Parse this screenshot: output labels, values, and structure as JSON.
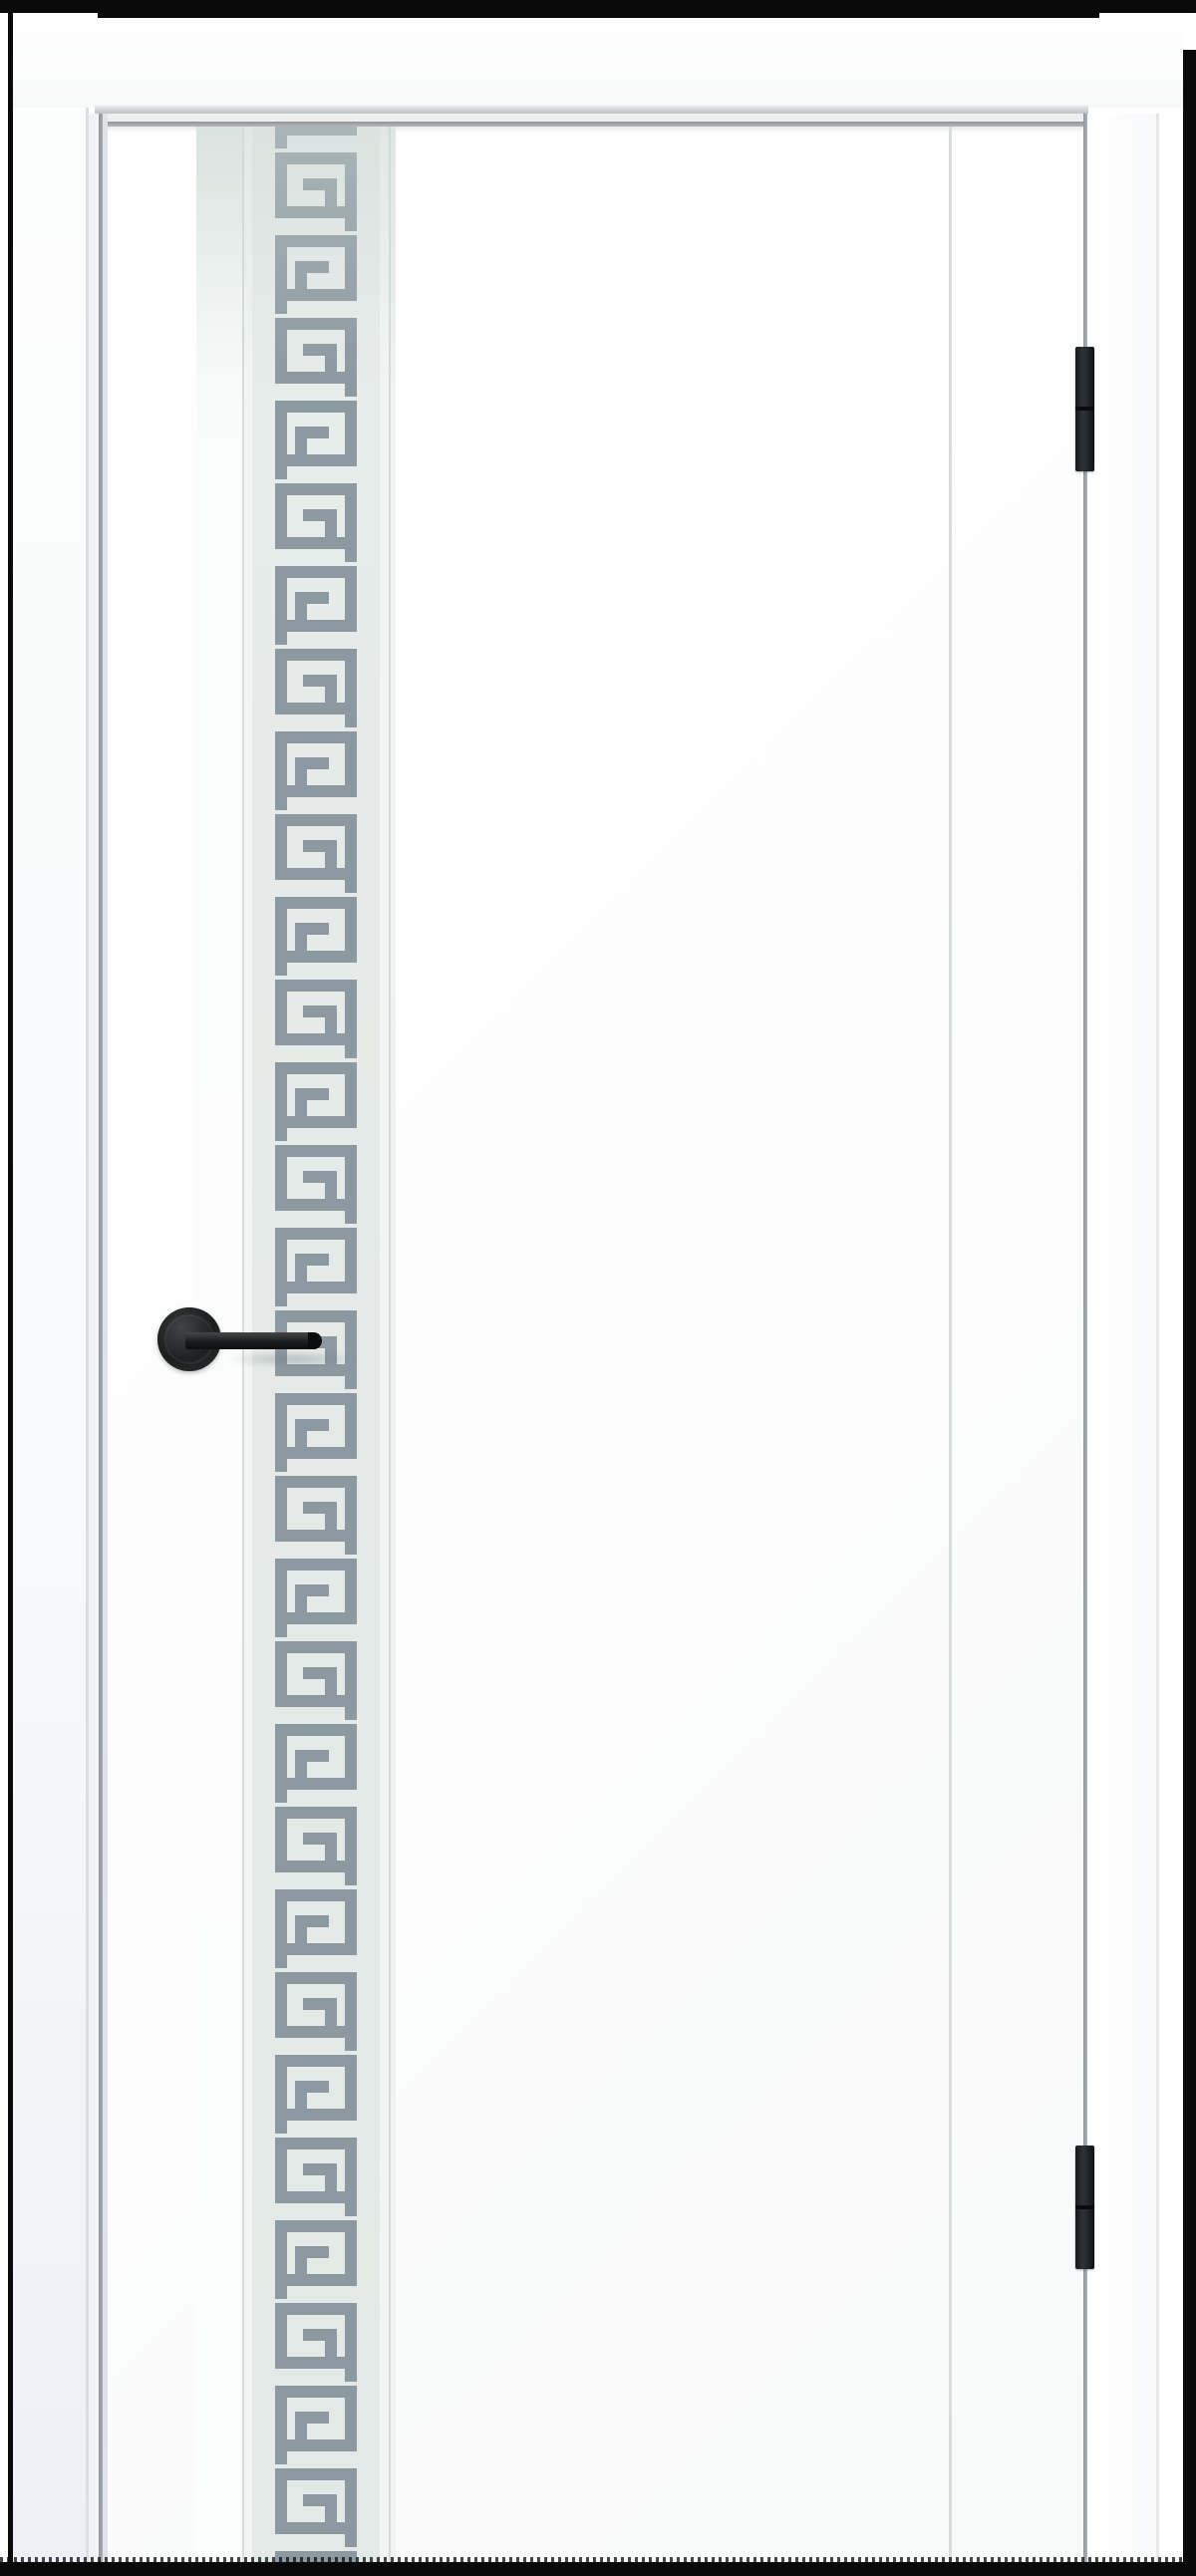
{
  "image": {
    "kind": "product-photo",
    "subject": "white interior door",
    "description": "White interior door in a white frame with a vertical frosted glass insert decorated with a Greek key meander pattern, black lever handle on a round rosette, and two black hinges"
  },
  "door": {
    "leaf_color_name": "white",
    "handle": {
      "type": "lever on round rosette",
      "color_name": "black",
      "side": "left"
    },
    "hinges": {
      "count": 2,
      "color_name": "black",
      "side": "right"
    },
    "glass_insert": {
      "position": "left third of leaf",
      "pattern": "greek-key-meander",
      "pattern_tiles_visible": 30,
      "orientation": "vertical full-height strip"
    },
    "photo_border": "partial black bars at top, bottom, left line and right strip"
  },
  "colors": {
    "border_black": "#0a0a0a",
    "door_white": "#fdfdfd",
    "glass_green": "#e7ecea",
    "pattern_gray": "#8d99a1",
    "gap_gray": "#90959a",
    "hardware_black": "#0b0c0d"
  }
}
